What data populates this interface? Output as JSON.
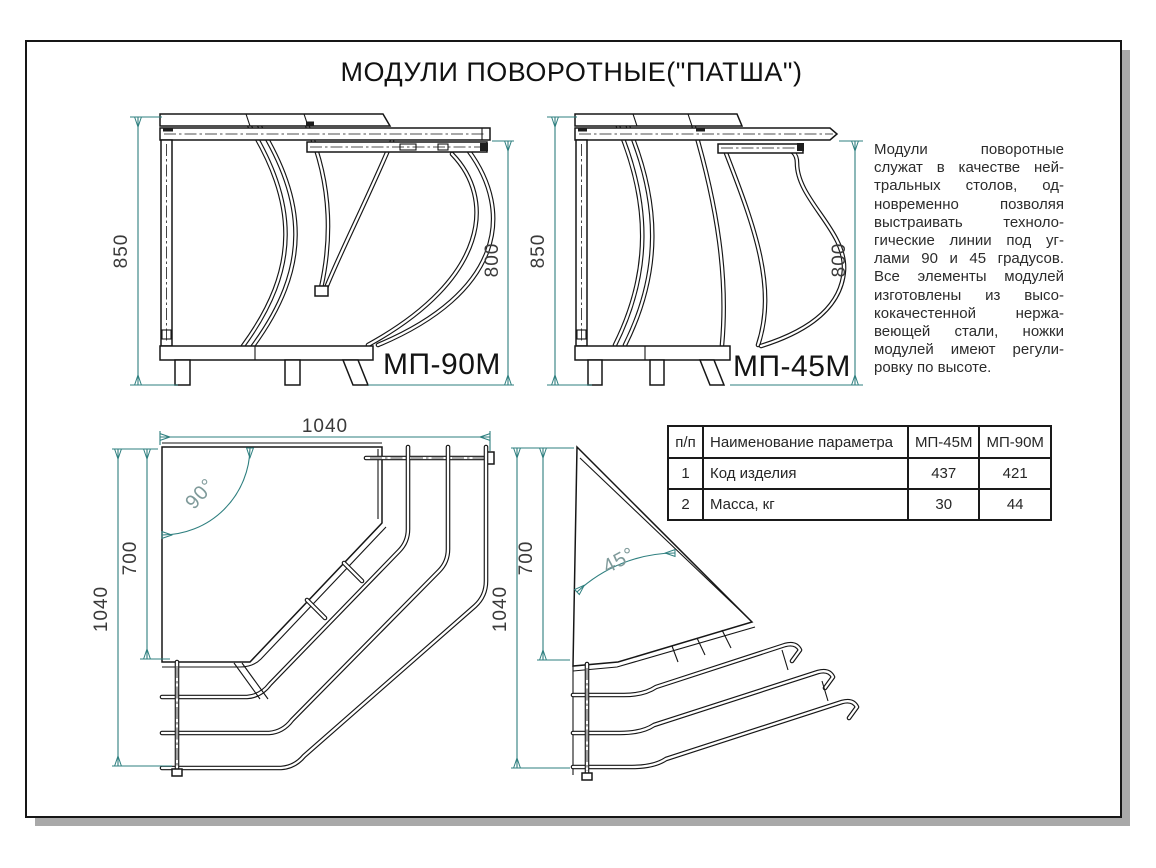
{
  "title": "МОДУЛИ ПОВОРОТНЫЕ(\"ПАТША\")",
  "views": {
    "side_90": {
      "label": "МП-90М",
      "height_dim": "850",
      "work_height_dim": "800"
    },
    "side_45": {
      "label": "МП-45М",
      "height_dim": "850",
      "work_height_dim": "800"
    },
    "top_90": {
      "angle_label": "90°",
      "top_dim": "1040",
      "left_dim": "1040",
      "inner_dim": "700"
    },
    "top_45": {
      "angle_label": "45°",
      "left_dim": "1040",
      "inner_dim": "700"
    }
  },
  "description": {
    "lines": [
      "Модули поворотные",
      "служат в качестве ней-",
      "тральных столов, од-",
      "новременно позволяя",
      "выстраивать техноло-",
      "гические линии под уг-",
      "лами 90 и 45 градусов.",
      "Все элементы модулей",
      "изготовлены из высо-",
      "кокачестенной нержа-",
      "веющей стали, ножки",
      "модулей имеют регули-",
      "ровку по высоте."
    ]
  },
  "spec_table": {
    "headers": [
      "п/п",
      "Наименование параметра",
      "МП-45М",
      "МП-90М"
    ],
    "rows": [
      [
        "1",
        "Код изделия",
        "437",
        "421"
      ],
      [
        "2",
        "Масса, кг",
        "30",
        "44"
      ]
    ]
  },
  "colors": {
    "drawing_line": "#161616",
    "dimension_line": "#2e7f7f",
    "dimension_text": "#3a3a3a",
    "angle_label": "#7f9a9a",
    "frame_shadow": "#a9a9a9"
  }
}
